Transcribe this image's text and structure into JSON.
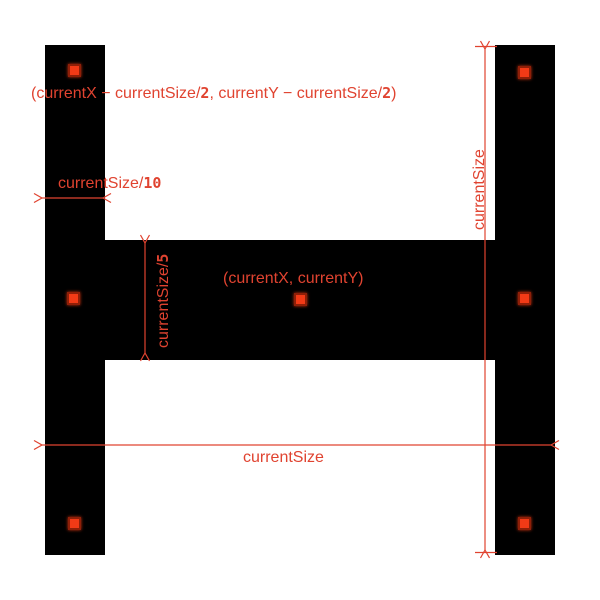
{
  "colors": {
    "background": "#ffffff",
    "shape": "#000000",
    "accent": "#e04330",
    "marker_fill": "#f23a16",
    "marker_border": "#8f1f08"
  },
  "labels": {
    "top_coord": {
      "pre": "(currentX − currentSize/",
      "den1": "2",
      "mid": ", currentY − currentSize/",
      "den2": "2",
      "post": ")"
    },
    "bar_width": {
      "pre": "currentSize/",
      "den": "10"
    },
    "crossbar_height": {
      "pre": "currentSize/",
      "den": "5"
    },
    "center_coord": "(currentX, currentY)",
    "full_height": "currentSize",
    "full_width": "currentSize"
  }
}
